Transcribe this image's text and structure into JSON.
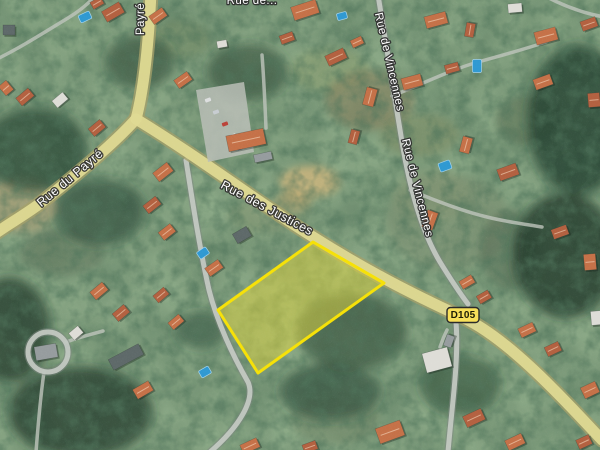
{
  "map": {
    "type": "satellite-imagery-with-road-overlay",
    "labels": {
      "street_top_clipped": "Rue de...",
      "street_payre_north": "Payré",
      "street_payre": "Rue du Payré",
      "street_justices": "Rue des Justices",
      "street_vincennes_1": "Rue de Vincennes",
      "street_vincennes_2": "Rue de Vincennes",
      "route_badge": "D105"
    },
    "colors": {
      "parcel_fill": "#e8dc3a",
      "parcel_stroke": "#ffe800",
      "main_road_fill": "#e7e093",
      "main_road_casing": "#a8a368",
      "minor_road_fill": "#cbd0c7",
      "badge_fill": "#f8e05a",
      "badge_border": "#2b2b2b",
      "label_fill": "#ffffff",
      "label_halo": "#2e2e2e",
      "pool_blue": "#2e9cd6"
    },
    "parcel": {
      "points": "313,242 384,283 258,373 218,310"
    },
    "features": {
      "fields": [
        [
          20,
          205,
          38,
          28,
          "#b0a478",
          0.75
        ],
        [
          330,
          70,
          40,
          22,
          "#8fa06b",
          0.5
        ],
        [
          370,
          100,
          45,
          30,
          "#8a7f5a",
          0.55
        ],
        [
          420,
          135,
          40,
          22,
          "#7d8a5e",
          0.5
        ],
        [
          310,
          182,
          30,
          16,
          "#cdb87d",
          0.9
        ],
        [
          293,
          202,
          18,
          10,
          "#c0ab70",
          0.8
        ],
        [
          448,
          222,
          62,
          48,
          "#7e9070",
          0.55
        ],
        [
          432,
          196,
          40,
          26,
          "#8a9a74",
          0.5
        ],
        [
          268,
          215,
          40,
          18,
          "#8a9a72",
          0.5
        ],
        [
          335,
          418,
          45,
          26,
          "#6f8160",
          0.45
        ],
        [
          62,
          252,
          42,
          24,
          "#5d7055",
          0.5
        ],
        [
          510,
          250,
          30,
          40,
          "#54684e",
          0.5
        ],
        [
          180,
          40,
          30,
          20,
          "#6d8258",
          0.4
        ],
        [
          530,
          120,
          35,
          25,
          "#4e6448",
          0.5
        ]
      ],
      "woods": [
        [
          578,
          120,
          50,
          75,
          "#23402b",
          0.8
        ],
        [
          565,
          255,
          52,
          62,
          "#1f3927",
          0.8
        ],
        [
          352,
          332,
          55,
          38,
          "#2b4733",
          0.6
        ],
        [
          330,
          392,
          50,
          28,
          "#2a4531",
          0.6
        ],
        [
          35,
          150,
          52,
          42,
          "#294530",
          0.75
        ],
        [
          100,
          212,
          45,
          33,
          "#294530",
          0.6
        ],
        [
          80,
          412,
          72,
          45,
          "#213b29",
          0.75
        ],
        [
          10,
          330,
          40,
          52,
          "#213b29",
          0.75
        ],
        [
          248,
          72,
          40,
          28,
          "#2d4a34",
          0.6
        ],
        [
          140,
          62,
          34,
          26,
          "#2d4a34",
          0.6
        ],
        [
          460,
          385,
          40,
          30,
          "#25402c",
          0.5
        ],
        [
          200,
          330,
          25,
          18,
          "#2e4b35",
          0.5
        ]
      ],
      "roads": [
        {
          "class": "thin",
          "d": "M-5,60 C20,48 45,32 68,18 C78,12 88,4 95,-4"
        },
        {
          "class": "thin",
          "d": "M545,-4 C562,5 582,13 604,17"
        },
        {
          "class": "thin",
          "d": "M410,190 C436,201 462,211 487,217 C507,222 524,224 542,227"
        },
        {
          "class": "thin",
          "d": "M392,96 C420,85 450,70 478,62 C500,56 522,50 546,42"
        },
        {
          "class": "thin",
          "d": "M262,55 C264,80 265,105 266,128"
        },
        {
          "class": "thin",
          "d": "M44,372 C40,400 38,426 36,452"
        },
        {
          "class": "thin",
          "d": "M66,342 C80,337 92,334 103,331"
        },
        {
          "class": "thin",
          "d": "M447,330 C444,336 442,341 440,347"
        },
        {
          "class": "minor",
          "d": "M378,-5 C386,45 394,95 402,142 C410,190 422,232 440,262 C448,275 456,288 468,304"
        },
        {
          "class": "minor",
          "d": "M186,160 C193,205 200,250 209,290 C217,322 233,356 248,382 C256,400 238,428 210,452"
        },
        {
          "class": "minor",
          "d": "M456,322 C459,360 452,405 448,452"
        },
        {
          "class": "minor",
          "d": "M28,352 a20,20 0 1 0 40,0 a20,20 0 1 0 -40,0"
        },
        {
          "class": "main",
          "d": "M151,-8 C149,35 145,85 136,119"
        },
        {
          "class": "main",
          "d": "M136,119 C112,146 70,180 38,205 C20,218 2,228 -8,236"
        },
        {
          "class": "main",
          "d": "M136,119 C200,158 255,200 310,235 C365,270 412,294 462,317 C507,338 557,392 602,440"
        }
      ],
      "parking": "196,90 244,82 254,152 208,162",
      "cars": [
        [
          208,
          100,
          -20,
          "#e8e8e8"
        ],
        [
          216,
          112,
          -20,
          "#d0d4d8"
        ],
        [
          225,
          124,
          -20,
          "#c23a2e"
        ],
        [
          233,
          136,
          -20,
          "#ffffff"
        ],
        [
          240,
          148,
          -20,
          "#5a6a8a"
        ]
      ],
      "roof_colors": {
        "o": "#b9613d",
        "O": "#cc7245",
        "g": "#9aa0a0",
        "d": "#5f6a68",
        "w": "#e6e4dc"
      },
      "buildings": [
        [
          113,
          12,
          20,
          12,
          -30,
          "o"
        ],
        [
          158,
          16,
          16,
          10,
          -35,
          "O"
        ],
        [
          97,
          3,
          12,
          8,
          -30,
          "o"
        ],
        [
          305,
          10,
          26,
          14,
          -18,
          "O"
        ],
        [
          287,
          38,
          14,
          9,
          -20,
          "o"
        ],
        [
          336,
          57,
          20,
          11,
          -25,
          "o"
        ],
        [
          357,
          42,
          12,
          8,
          -25,
          "O"
        ],
        [
          222,
          44,
          10,
          7,
          -10,
          "w"
        ],
        [
          436,
          20,
          22,
          12,
          -15,
          "O"
        ],
        [
          470,
          30,
          14,
          9,
          -80,
          "o"
        ],
        [
          515,
          8,
          14,
          9,
          -5,
          "w"
        ],
        [
          546,
          36,
          22,
          13,
          -15,
          "O"
        ],
        [
          589,
          24,
          16,
          10,
          -20,
          "o"
        ],
        [
          9,
          30,
          12,
          10,
          0,
          "d"
        ],
        [
          25,
          97,
          16,
          10,
          -40,
          "o"
        ],
        [
          6,
          88,
          10,
          12,
          -40,
          "O"
        ],
        [
          60,
          100,
          14,
          9,
          -40,
          "w"
        ],
        [
          97,
          128,
          15,
          10,
          -40,
          "o"
        ],
        [
          183,
          80,
          16,
          10,
          -35,
          "O"
        ],
        [
          246,
          140,
          38,
          16,
          -12,
          "O"
        ],
        [
          263,
          157,
          18,
          8,
          -12,
          "g"
        ],
        [
          370,
          97,
          18,
          11,
          -75,
          "O"
        ],
        [
          354,
          137,
          14,
          9,
          -75,
          "o"
        ],
        [
          412,
          82,
          20,
          12,
          -15,
          "O"
        ],
        [
          452,
          68,
          14,
          9,
          -15,
          "o"
        ],
        [
          543,
          82,
          18,
          11,
          -20,
          "O"
        ],
        [
          594,
          100,
          12,
          14,
          -5,
          "o"
        ],
        [
          466,
          145,
          16,
          10,
          -75,
          "O"
        ],
        [
          508,
          172,
          20,
          12,
          -20,
          "o"
        ],
        [
          163,
          172,
          18,
          11,
          -38,
          "O"
        ],
        [
          152,
          205,
          16,
          10,
          -38,
          "o"
        ],
        [
          167,
          232,
          15,
          10,
          -38,
          "O"
        ],
        [
          242,
          235,
          16,
          11,
          -30,
          "d"
        ],
        [
          214,
          268,
          16,
          10,
          -35,
          "O"
        ],
        [
          430,
          220,
          18,
          11,
          -70,
          "O"
        ],
        [
          560,
          232,
          16,
          10,
          -20,
          "o"
        ],
        [
          467,
          282,
          14,
          9,
          -30,
          "O"
        ],
        [
          484,
          297,
          13,
          9,
          -30,
          "o"
        ],
        [
          590,
          262,
          12,
          16,
          -5,
          "O"
        ],
        [
          99,
          291,
          16,
          10,
          -40,
          "O"
        ],
        [
          121,
          313,
          15,
          10,
          -40,
          "o"
        ],
        [
          76,
          333,
          12,
          9,
          -40,
          "w"
        ],
        [
          161,
          295,
          14,
          9,
          -40,
          "o"
        ],
        [
          176,
          322,
          14,
          9,
          -40,
          "O"
        ],
        [
          527,
          330,
          16,
          10,
          -25,
          "O"
        ],
        [
          553,
          349,
          15,
          10,
          -25,
          "o"
        ],
        [
          596,
          318,
          10,
          14,
          -5,
          "w"
        ],
        [
          437,
          360,
          26,
          20,
          -15,
          "w"
        ],
        [
          590,
          390,
          16,
          12,
          -25,
          "O"
        ],
        [
          46,
          352,
          22,
          14,
          -10,
          "g"
        ],
        [
          126,
          357,
          34,
          12,
          -28,
          "d"
        ],
        [
          143,
          390,
          18,
          11,
          -30,
          "O"
        ],
        [
          390,
          432,
          26,
          16,
          -20,
          "O"
        ],
        [
          474,
          418,
          20,
          12,
          -25,
          "o"
        ],
        [
          515,
          442,
          18,
          11,
          -25,
          "O"
        ],
        [
          584,
          442,
          14,
          10,
          -25,
          "o"
        ],
        [
          250,
          446,
          18,
          10,
          -25,
          "O"
        ],
        [
          449,
          341,
          12,
          8,
          -70,
          "g"
        ],
        [
          310,
          447,
          14,
          9,
          -20,
          "o"
        ]
      ],
      "pools": [
        [
          85,
          17,
          12,
          8,
          -25
        ],
        [
          342,
          16,
          10,
          7,
          -15
        ],
        [
          477,
          66,
          9,
          13,
          0
        ],
        [
          445,
          166,
          12,
          9,
          -20
        ],
        [
          203,
          253,
          11,
          8,
          -35
        ],
        [
          205,
          372,
          11,
          8,
          -30
        ]
      ]
    }
  }
}
